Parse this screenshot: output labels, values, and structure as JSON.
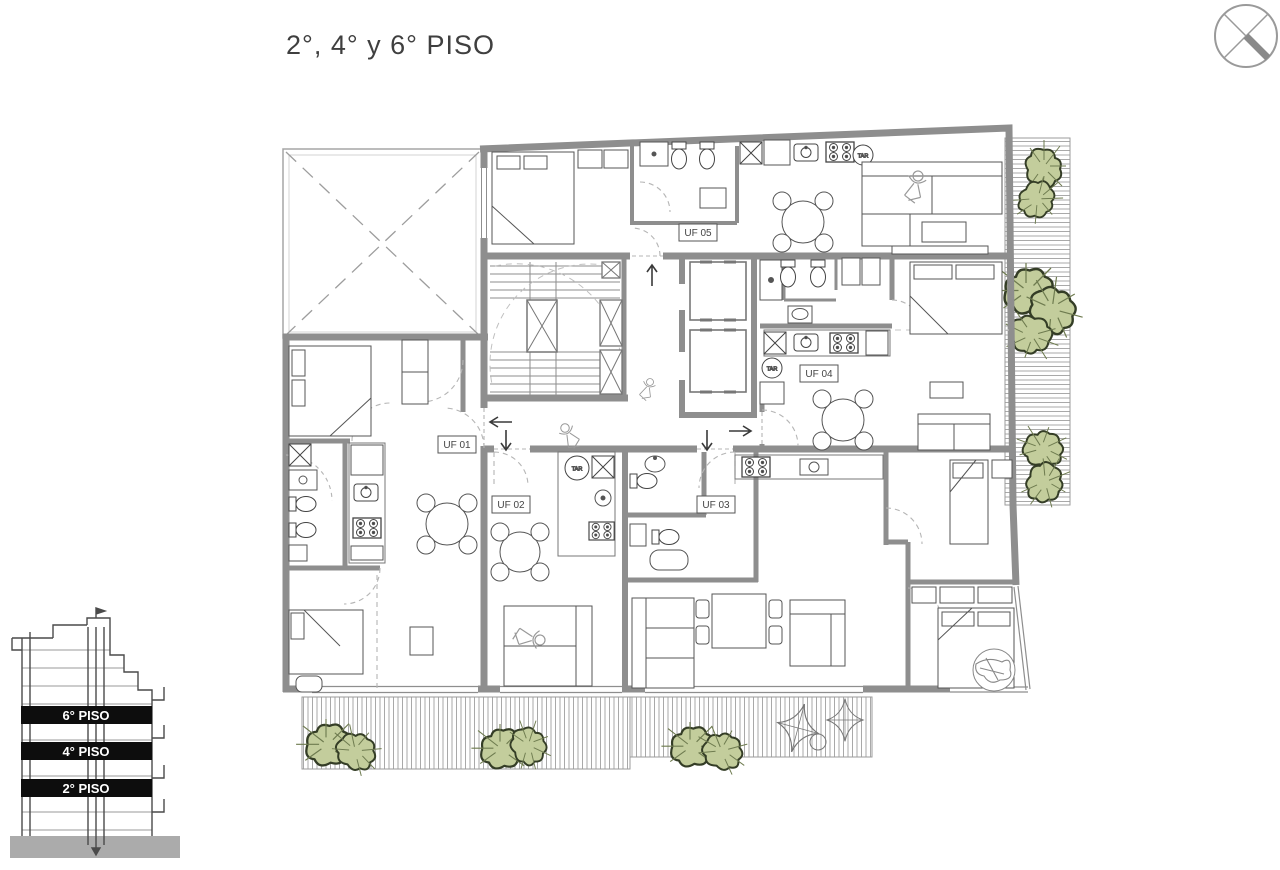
{
  "title": "2°, 4° y 6° PISO",
  "plan": {
    "units": [
      {
        "label": "UF 01"
      },
      {
        "label": "UF 02"
      },
      {
        "label": "UF 03"
      },
      {
        "label": "UF 04"
      },
      {
        "label": "UF 05"
      }
    ],
    "tar": [
      "TAR",
      "TAR",
      "TAR"
    ],
    "colors": {
      "wall": "#8e8e8e",
      "plant_fill": "#c3cd9c",
      "plant_edge": "#343d26"
    }
  },
  "elevation": {
    "floors": [
      "6° PISO",
      "4° PISO",
      "2° PISO"
    ]
  }
}
